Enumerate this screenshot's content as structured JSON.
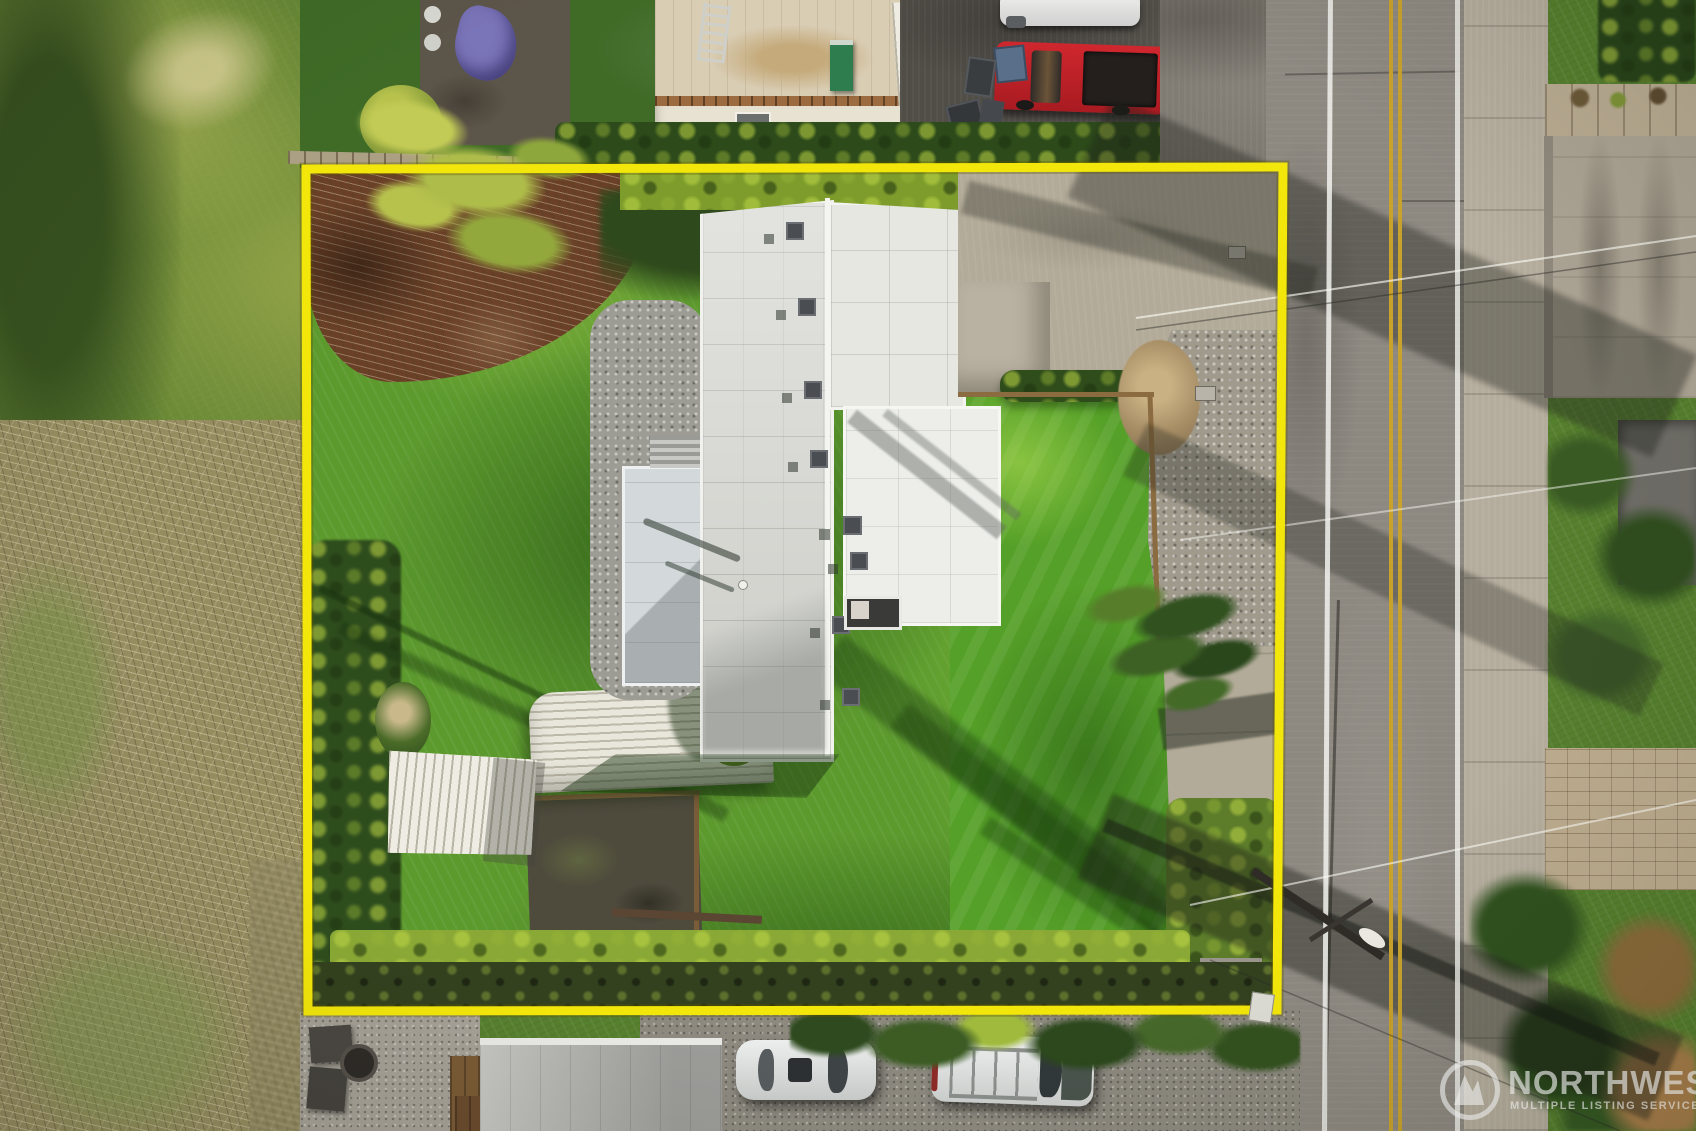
{
  "image": {
    "kind": "aerial drone photograph",
    "subject": "single-family property with yellow lot-boundary overlay",
    "orientation": "top-down"
  },
  "watermark": {
    "brand": "NORTHWEST",
    "tagline": "MULTIPLE LISTING SERVICE",
    "logo": "circular MLS emblem"
  },
  "boundary": {
    "color": "#f2e60a",
    "meaning": "property line outline"
  },
  "palette": {
    "lawn_bright": "#6fae3a",
    "lawn_dark": "#2f5c1d",
    "roof_white": "#e6e7e1",
    "road_asphalt": "#8d8880",
    "road_center_line": "#c9a22c",
    "road_edge_line": "#f2f2ee",
    "mulch_brown": "#6a4027",
    "truck_red": "#c01f26",
    "hedge_dark": "#2c4a1a",
    "hedge_sunlit": "#9ab832"
  },
  "scene_objects": {
    "main_house": "flat white membrane roof with vents and chimney",
    "patio_cover": "light gray flat cover at west side of house",
    "carport_shed": "long corrugated metal roof",
    "small_shed": "corrugated metal outbuilding",
    "driveway": "concrete apron and gravel strip on east side",
    "street": "two-lane road with double yellow center line",
    "vehicles": [
      "red pickup truck",
      "silver car",
      "white sedan",
      "white SUV with roof rails"
    ],
    "landscape": [
      "front lawn",
      "back lawn",
      "perimeter hedges",
      "mulch bed",
      "evergreen trees",
      "bare winter brush"
    ]
  }
}
